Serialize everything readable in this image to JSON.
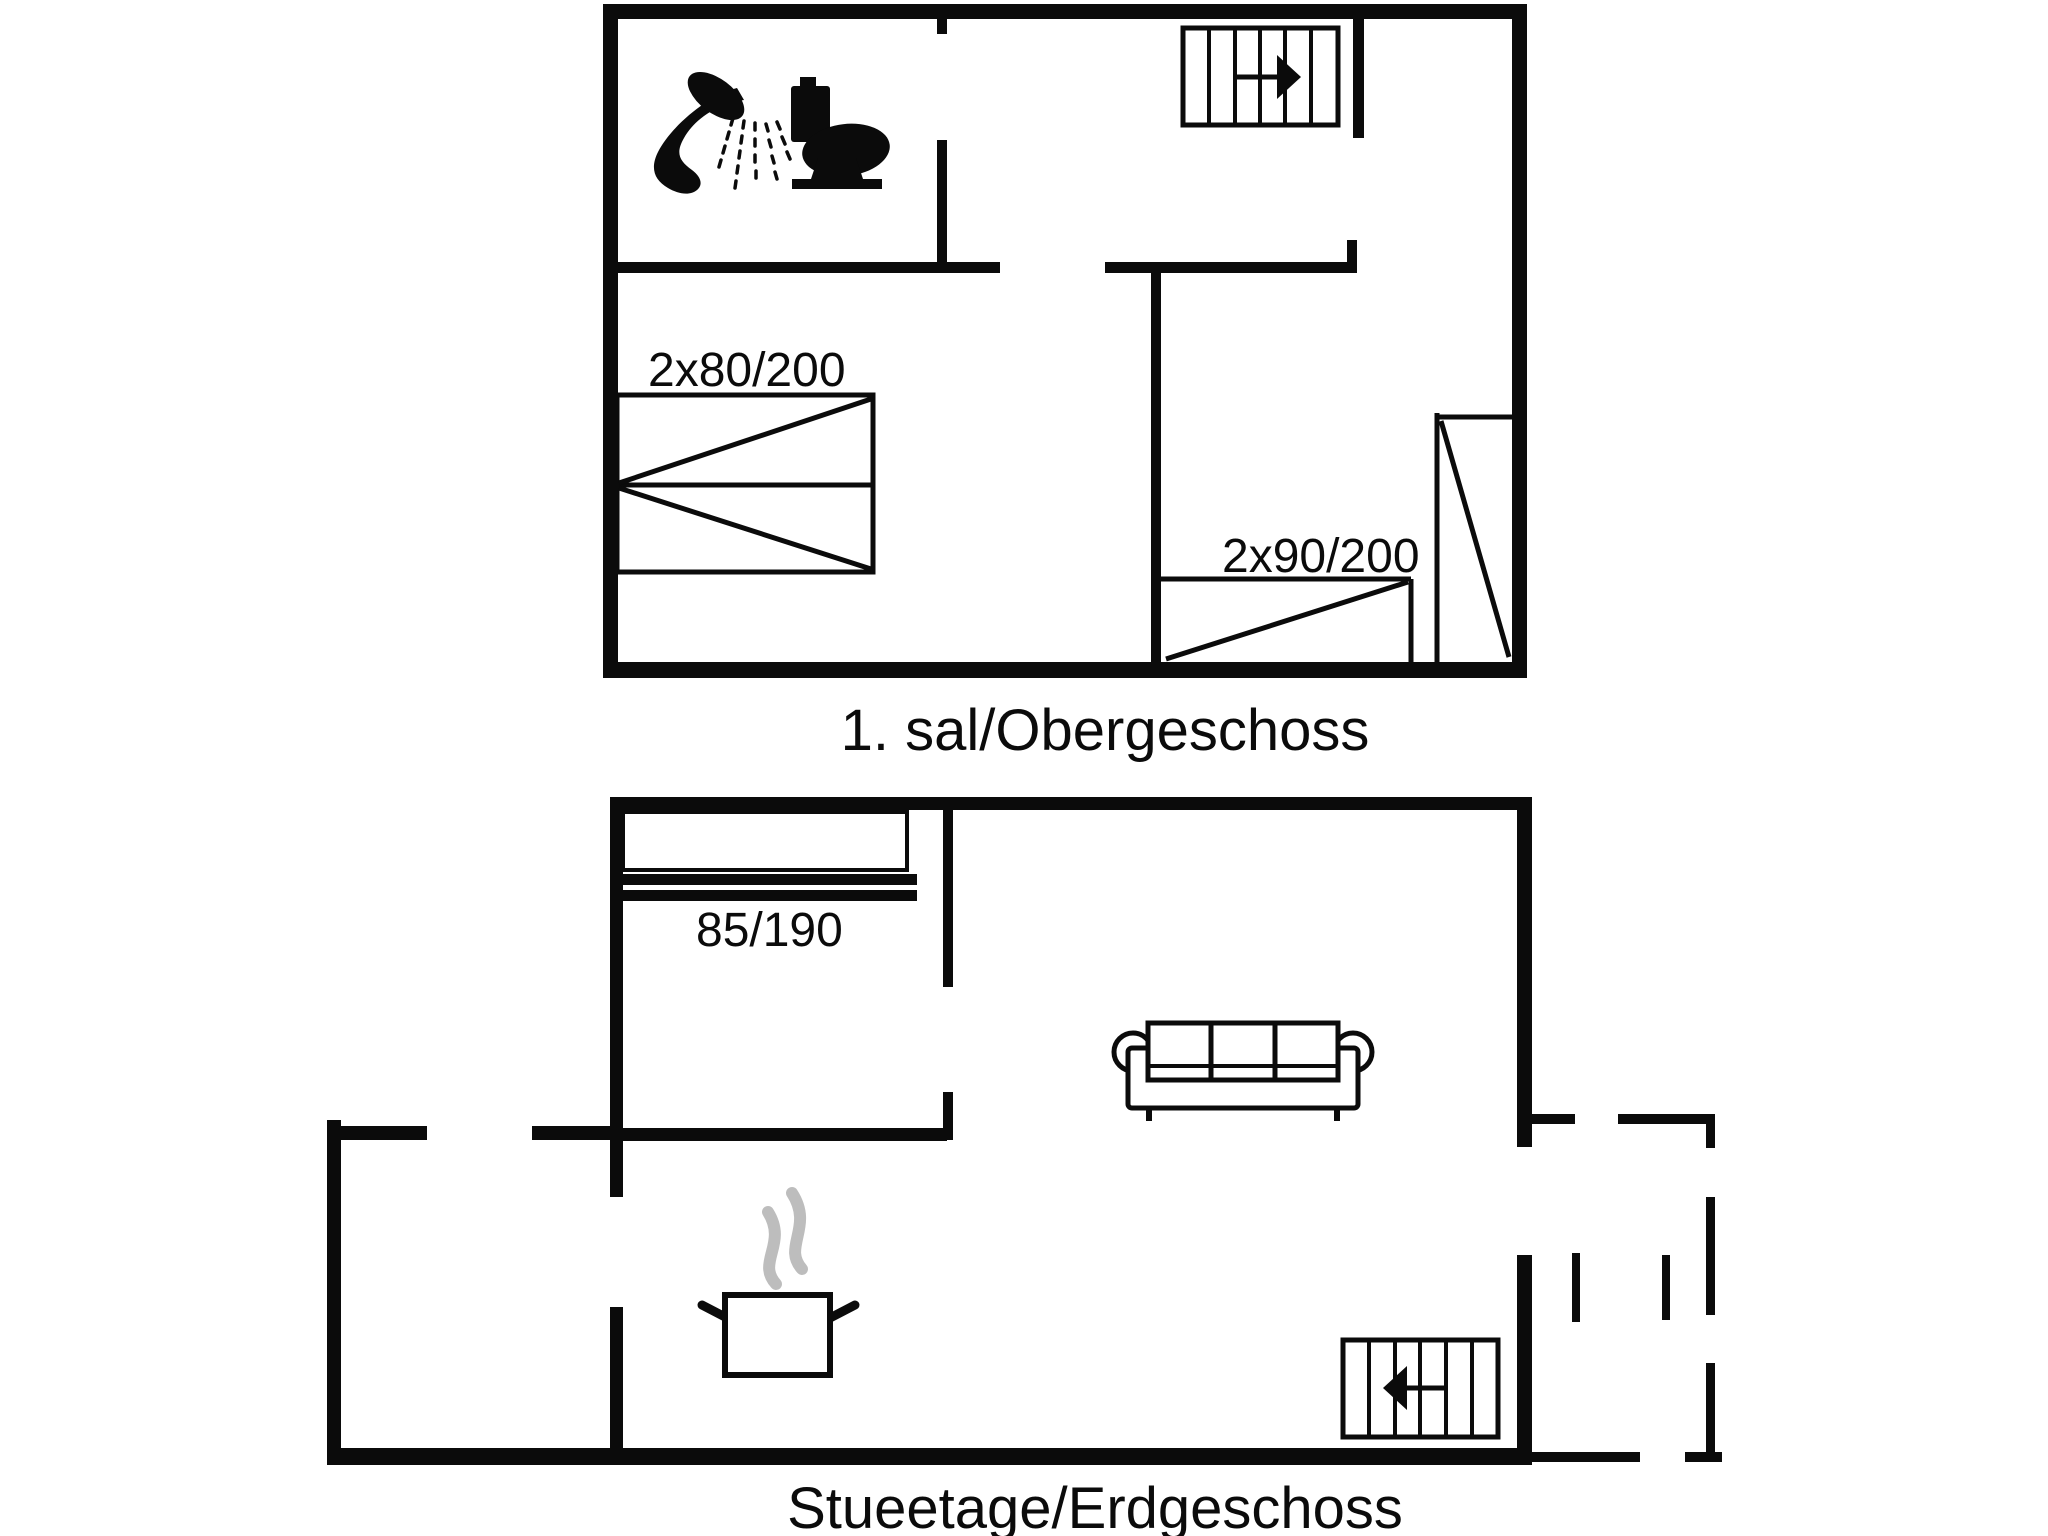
{
  "canvas": {
    "background": "#ffffff",
    "ink": "#0b0b0b",
    "steam_color": "#bdbdbd"
  },
  "upper_floor": {
    "caption": "1. sal/Obergeschoss",
    "bed_labels": {
      "double": "2x80/200",
      "twin": "2x90/200"
    },
    "icons": [
      "shower-icon",
      "toilet-icon",
      "stairs-up-icon"
    ],
    "stairs_direction": "right"
  },
  "ground_floor": {
    "caption": "Stueetage/Erdgeschoss",
    "bed_label": "85/190",
    "icons": [
      "sofa-icon",
      "cooking-pot-icon",
      "stairs-down-icon"
    ],
    "stairs_direction": "left",
    "terrace_outline": "dashed"
  }
}
